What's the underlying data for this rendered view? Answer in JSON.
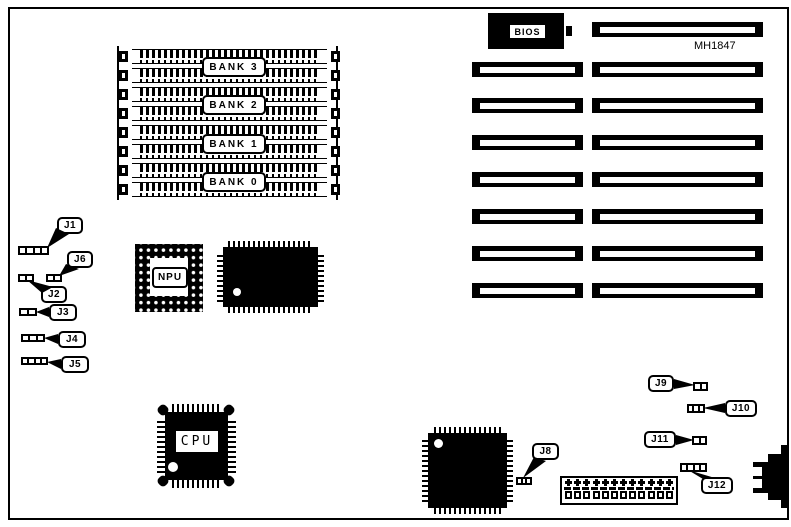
{
  "page": {
    "background": "#ffffff",
    "ink": "#000000"
  },
  "silkscreen": {
    "model": "MH1847"
  },
  "chips": {
    "bios": {
      "label": "BIOS"
    },
    "npu": {
      "label": "NPU"
    },
    "cpu": {
      "label": "CPU"
    }
  },
  "memory": {
    "bank_labels": [
      "BANK 3",
      "BANK 2",
      "BANK 1",
      "BANK 0"
    ],
    "simm_socket_rows": 8
  },
  "slots": {
    "left_column_count": 7,
    "right_column_count": 8
  },
  "jumpers": {
    "j1": "J1",
    "j2": "J2",
    "j3": "J3",
    "j4": "J4",
    "j5": "J5",
    "j6": "J6",
    "j8": "J8",
    "j9": "J9",
    "j10": "J10",
    "j11": "J11",
    "j12": "J12"
  }
}
